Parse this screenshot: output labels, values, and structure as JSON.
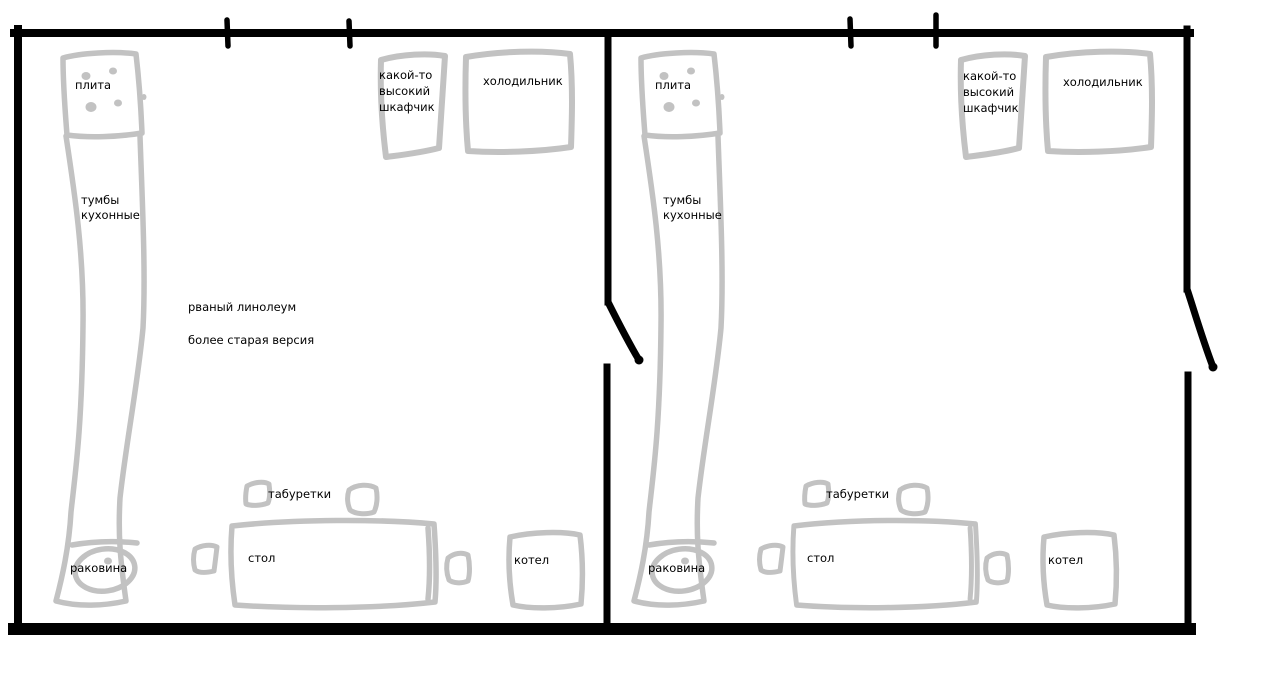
{
  "canvas": {
    "background": "#ffffff",
    "wall_color": "#000000",
    "sketch_color": "#c2c2c2",
    "text_color": "#000000"
  },
  "rooms": [
    {
      "id": "left-kitchen",
      "labels": {
        "stove": "плита",
        "cabinets_line1": "тумбы",
        "cabinets_line2": "кухонные",
        "tall_cabinet_line1": "какой-то",
        "tall_cabinet_line2": "высокий",
        "tall_cabinet_line3": "шкафчик",
        "fridge": "холодильник",
        "stools": "табуретки",
        "table": "стол",
        "sink": "раковина",
        "boiler": "котел"
      },
      "notes": [
        "рваный линолеум",
        "более старая версия"
      ]
    },
    {
      "id": "right-kitchen",
      "labels": {
        "stove": "плита",
        "cabinets_line1": "тумбы",
        "cabinets_line2": "кухонные",
        "tall_cabinet_line1": "какой-то",
        "tall_cabinet_line2": "высокий",
        "tall_cabinet_line3": "шкафчик",
        "fridge": "холодильник",
        "stools": "табуретки",
        "table": "стол",
        "sink": "раковина",
        "boiler": "котел"
      },
      "notes": []
    }
  ]
}
